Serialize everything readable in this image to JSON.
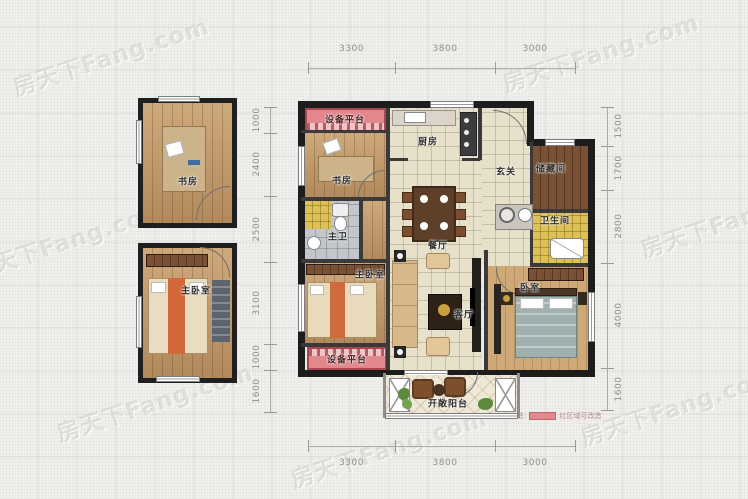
{
  "watermark": {
    "text": "房天下Fang.com"
  },
  "dims": {
    "top": [
      "3300",
      "3800",
      "3000"
    ],
    "bottom": [
      "3300",
      "3800",
      "3000"
    ],
    "left": [
      "1000",
      "2400",
      "2500",
      "3100",
      "1000",
      "1600"
    ],
    "right": [
      "1500",
      "1700",
      "2800",
      "4000",
      "1600"
    ]
  },
  "rooms": {
    "study_detached": "书房",
    "master_bedroom_detached": "主卧室",
    "equip_top": "设备平台",
    "study_main": "书房",
    "master_bath": "主卫",
    "master_bedroom_main": "主卧室",
    "equip_bottom": "设备平台",
    "kitchen": "厨房",
    "dining": "餐厅",
    "entry": "玄关",
    "storage": "储藏间",
    "bath": "卫生间",
    "living": "客厅",
    "bedroom": "卧室",
    "balcony": "开敞阳台"
  },
  "legend": {
    "note_label": "注:",
    "text": "红区域可改造"
  },
  "colors": {
    "highlight": "#e2878c",
    "wall": "#1d1d1d",
    "background": "#f1f0ee"
  }
}
